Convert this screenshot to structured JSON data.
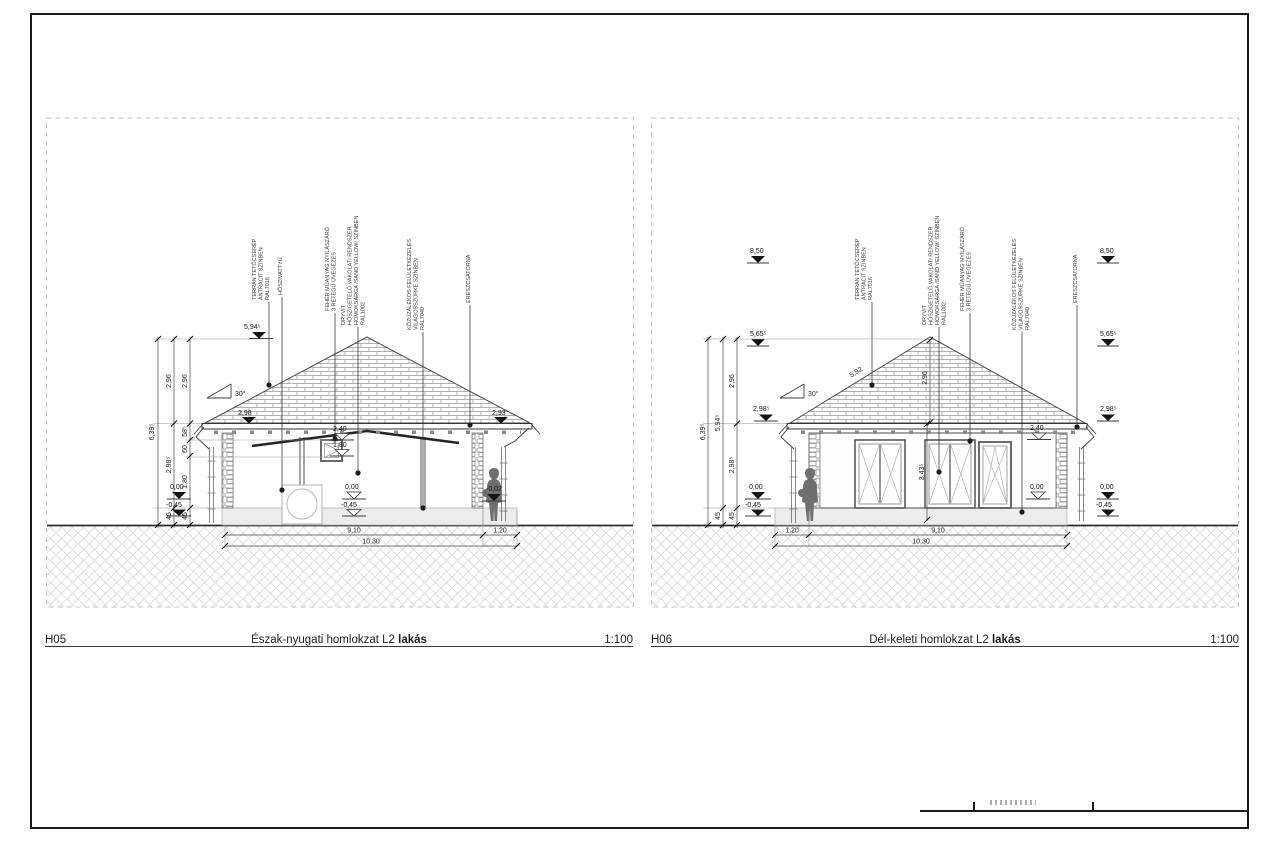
{
  "sheet": {
    "frame_color": "#1a1a1a",
    "paper_color": "#ffffff"
  },
  "materials": {
    "tile": [
      "TERRÁN TETŐCSERÉP",
      "ANTRACIT SZÍNBEN",
      "RAL7016"
    ],
    "plaster": [
      "DRYVIT",
      "HŐSZIGETELŐ VAKOLATI RENDSZER",
      "HOMOKSÁRGA /SAND YELLOW/ SZÍNBEN",
      "RAL1002"
    ],
    "window": [
      "FEHÉR MŰANYAG NYÍLÁSZÁRÓ",
      "3 RÉTEGŰ ÜVEGEZÉS"
    ],
    "gravel": [
      "KŐZÚZALÉKOS FELÜLETKEZELÉS",
      "VILÁGOSSZÜRKE SZÍNBEN",
      "RAL7040"
    ],
    "gutter": "ERESZCSATORNA",
    "heat_pump": "HŐSZIVATTYÚ"
  },
  "views": {
    "left": {
      "code": "H05",
      "title": "Észak-nyugati homlokzat L2",
      "title_bold": "lakás",
      "scale": "1:100",
      "roof_slope": "30°",
      "levels": {
        "ridge": "5,94⁵",
        "eave_left": "2,98",
        "eave_right": "2,93",
        "lintel": "2,40",
        "sill": "1,80",
        "zero": "0,00",
        "minus_45": "-0,45",
        "terrace": "-0,02"
      },
      "dims": {
        "total_height": "6,39⁵",
        "plinth": "45",
        "wall_height": "2,98⁵",
        "roof_height": "2,96",
        "parapet": "1,80",
        "opening": "60",
        "header": "58⁵",
        "width_main": "9,10",
        "width_terrace": "1,20",
        "width_total": "10,30"
      }
    },
    "right": {
      "code": "H06",
      "title": "Dél-keleti homlokzat L2",
      "title_bold": "lakás",
      "scale": "1:100",
      "roof_slope": "30°",
      "levels": {
        "height_max": "8,50",
        "upper": "5,65⁵",
        "eave": "2,98⁵",
        "lintel": "2,40",
        "zero": "0,00",
        "minus_45": "-0,45"
      },
      "dims": {
        "total_height": "6,39⁵",
        "ridge_height": "5,94⁵",
        "plinth": "45",
        "wall_height": "2,98⁵",
        "roof_height": "2,96",
        "roof_slope_length": "5,92",
        "wall_dim": "3,43⁵",
        "width_terrace": "1,20",
        "width_main": "9,10",
        "width_total": "10,30"
      }
    }
  }
}
